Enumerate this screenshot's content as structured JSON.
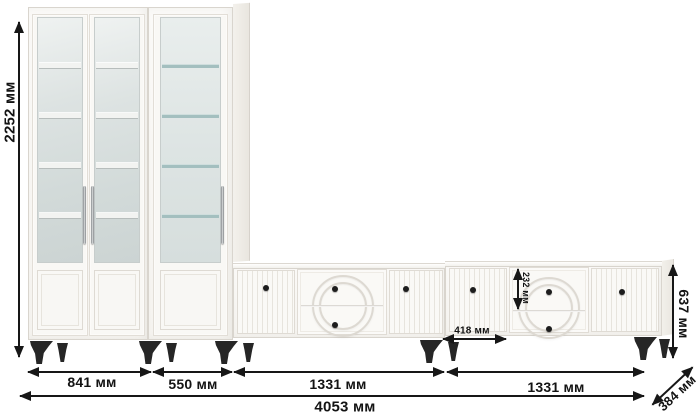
{
  "diagram": {
    "kind": "furniture dimension drawing",
    "units": "мм"
  },
  "dimensions": {
    "total_height": "2252 мм",
    "double_cabinet_width": "841 мм",
    "single_cabinet_width": "550 мм",
    "tv_stand_left_width": "1331 мм",
    "tv_stand_right_width": "1331 мм",
    "total_width": "4053 мм",
    "tv_stand_height": "637 мм",
    "depth": "384 мм",
    "drawer_height": "232 мм",
    "tv_door_width": "418 мм"
  },
  "colors": {
    "background": "#ffffff",
    "furniture_body": "#f8f7f4",
    "furniture_outline": "#d9d5ce",
    "glass": "#dde3e2",
    "glass_shelf": "#a3bfbf",
    "dimension_lines": "#171717",
    "legs": "#262626",
    "chrome_handle": "#d8dadb",
    "knob": "#1d1d1d"
  }
}
